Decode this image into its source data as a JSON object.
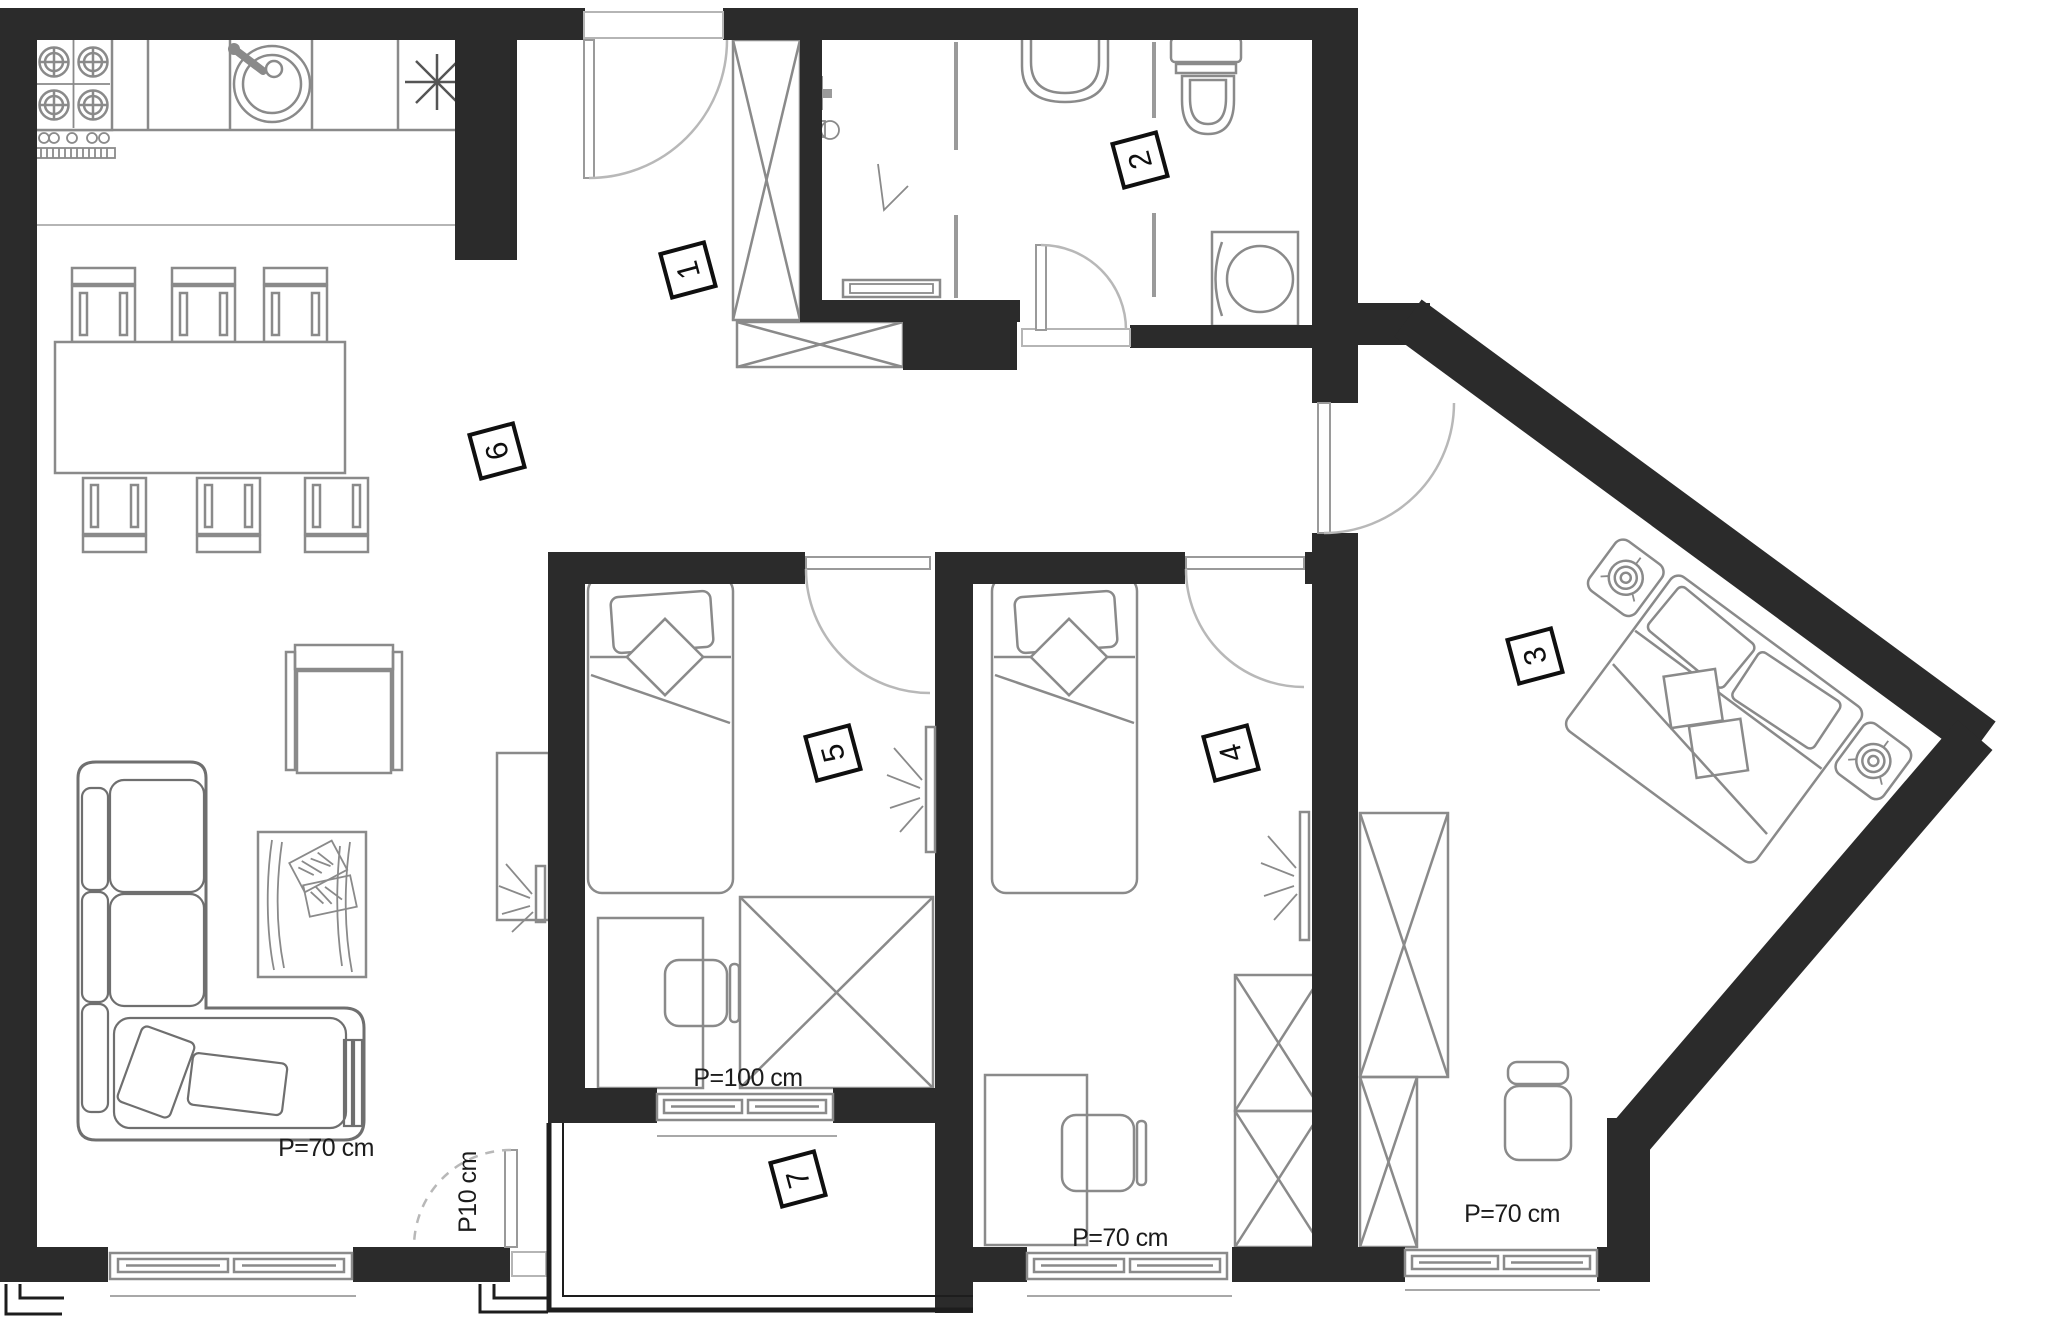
{
  "plan": {
    "colors": {
      "wall": "#2b2b2b",
      "furniture_line": "#8a8a8a",
      "door_swing": "#b8b8b8",
      "background": "#ffffff",
      "label_border": "#0f0f0f"
    },
    "rooms": [
      {
        "label": "1"
      },
      {
        "label": "2"
      },
      {
        "label": "3"
      },
      {
        "label": "4"
      },
      {
        "label": "5"
      },
      {
        "label": "6"
      },
      {
        "label": "7"
      }
    ],
    "dimensions": [
      {
        "text": "P=70 cm"
      },
      {
        "text": "P10 cm"
      },
      {
        "text": "P=100 cm"
      },
      {
        "text": "P=70 cm"
      },
      {
        "text": "P=70 cm"
      }
    ]
  }
}
